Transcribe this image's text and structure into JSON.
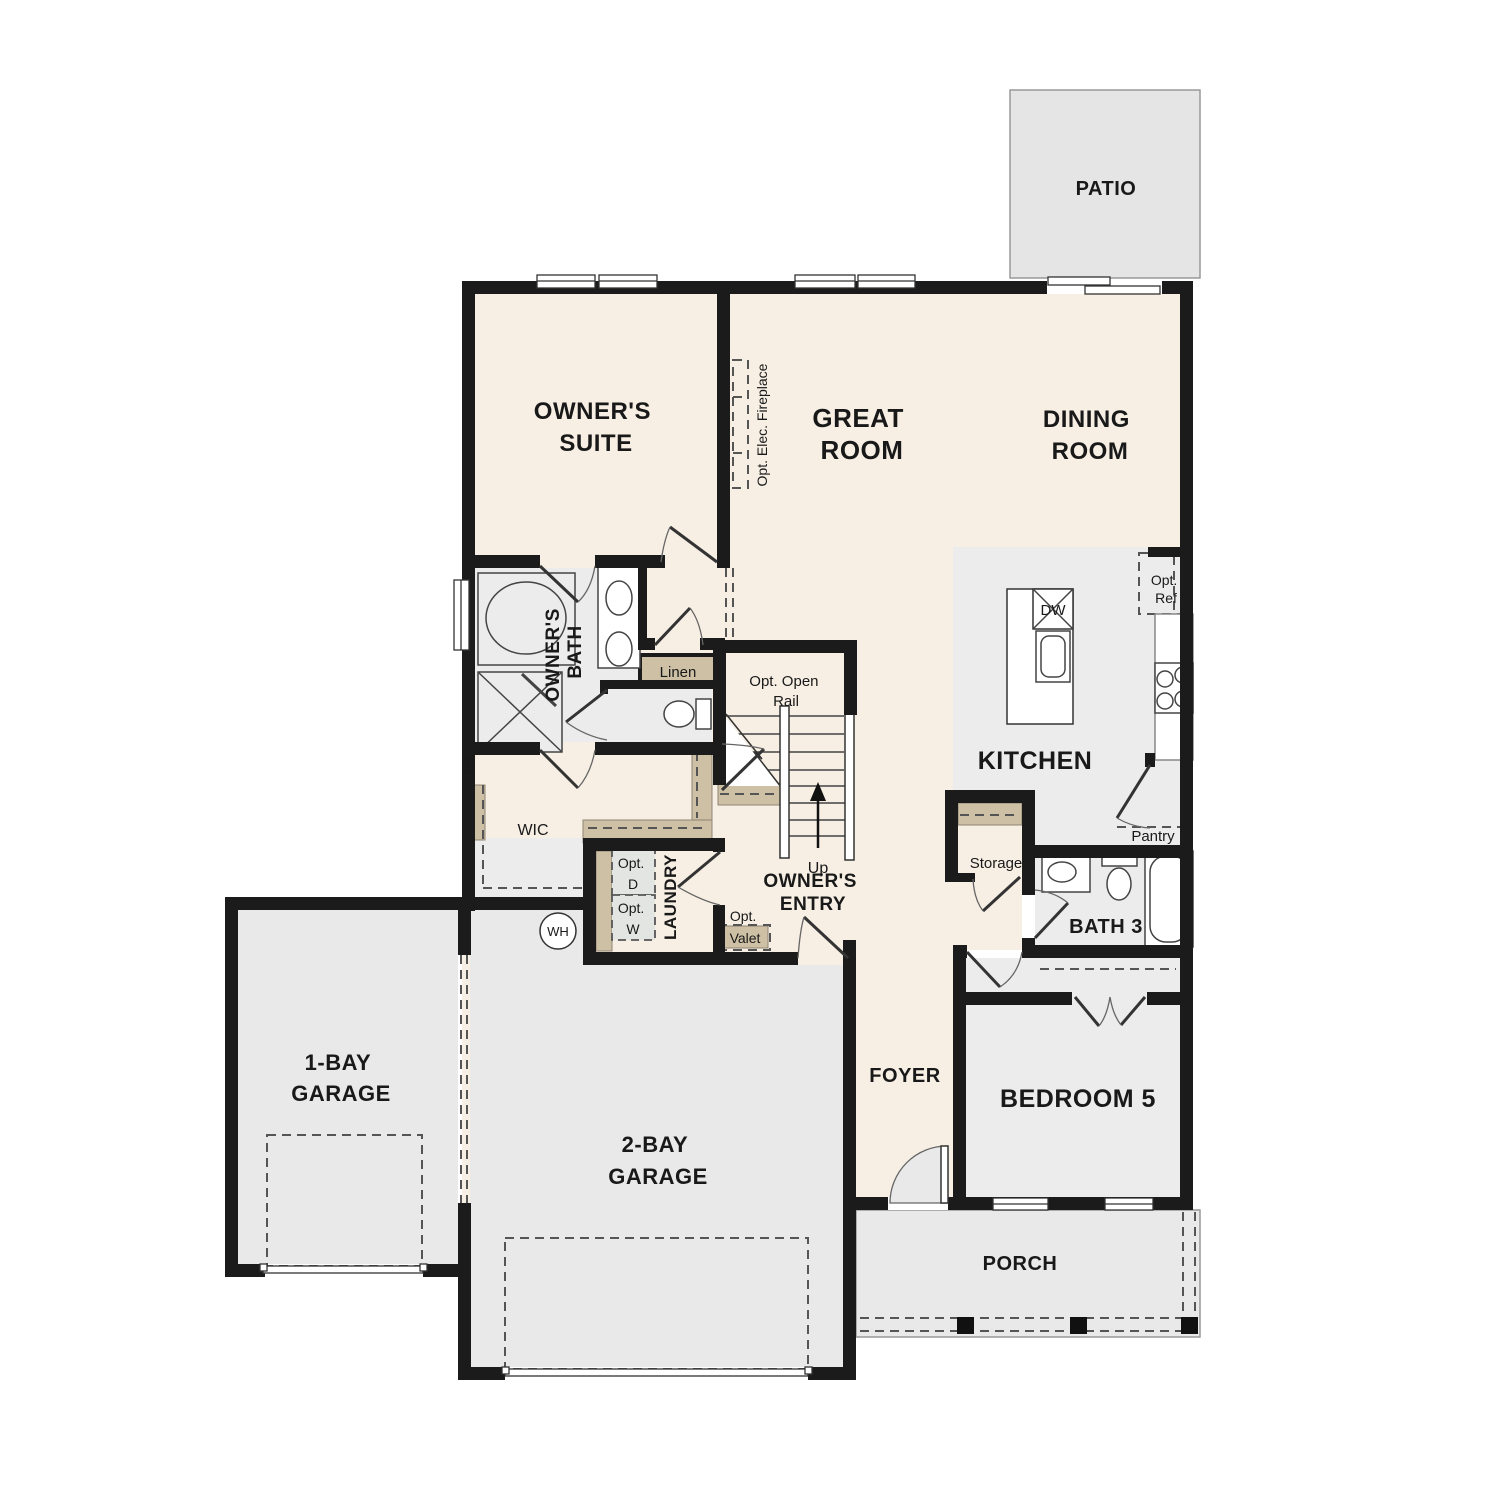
{
  "plan": {
    "rooms": {
      "patio": "PATIO",
      "owners_suite": {
        "l1": "OWNER'S",
        "l2": "SUITE"
      },
      "great_room": {
        "l1": "GREAT",
        "l2": "ROOM"
      },
      "dining_room": {
        "l1": "DINING",
        "l2": "ROOM"
      },
      "owners_bath": {
        "l1": "OWNER'S",
        "l2": "BATH"
      },
      "kitchen": "KITCHEN",
      "pantry": "Pantry",
      "storage": "Storage",
      "bath3": "BATH 3",
      "bedroom5": "BEDROOM 5",
      "foyer": "FOYER",
      "wic": "WIC",
      "laundry": "LAUNDRY",
      "owners_entry": {
        "l1": "OWNER'S",
        "l2": "ENTRY"
      },
      "linen": "Linen",
      "lin": "Lin",
      "garage_1bay": {
        "l1": "1-BAY",
        "l2": "GARAGE"
      },
      "garage_2bay": {
        "l1": "2-BAY",
        "l2": "GARAGE"
      },
      "porch": "PORCH"
    },
    "annotations": {
      "opt_elec_fireplace": "Opt. Elec. Fireplace",
      "opt_open_rail": {
        "l1": "Opt. Open",
        "l2": "Rail"
      },
      "up": "Up",
      "opt_d": {
        "l1": "Opt.",
        "l2": "D"
      },
      "opt_w": {
        "l1": "Opt.",
        "l2": "W"
      },
      "wh": "WH",
      "opt_valet": {
        "l1": "Opt.",
        "l2": "Valet"
      },
      "opt_ref": {
        "l1": "Opt.",
        "l2": "Ref"
      },
      "dw": "DW"
    },
    "colors": {
      "floor_main": "#f7efe4",
      "floor_tile": "#ececec",
      "floor_garage": "#e9e9e9",
      "floor_patio": "#e5e5e5",
      "wall": "#1b1b1b",
      "shelf_tan": "#cdc0a5",
      "appliance_gray": "#e3e5e3"
    }
  }
}
